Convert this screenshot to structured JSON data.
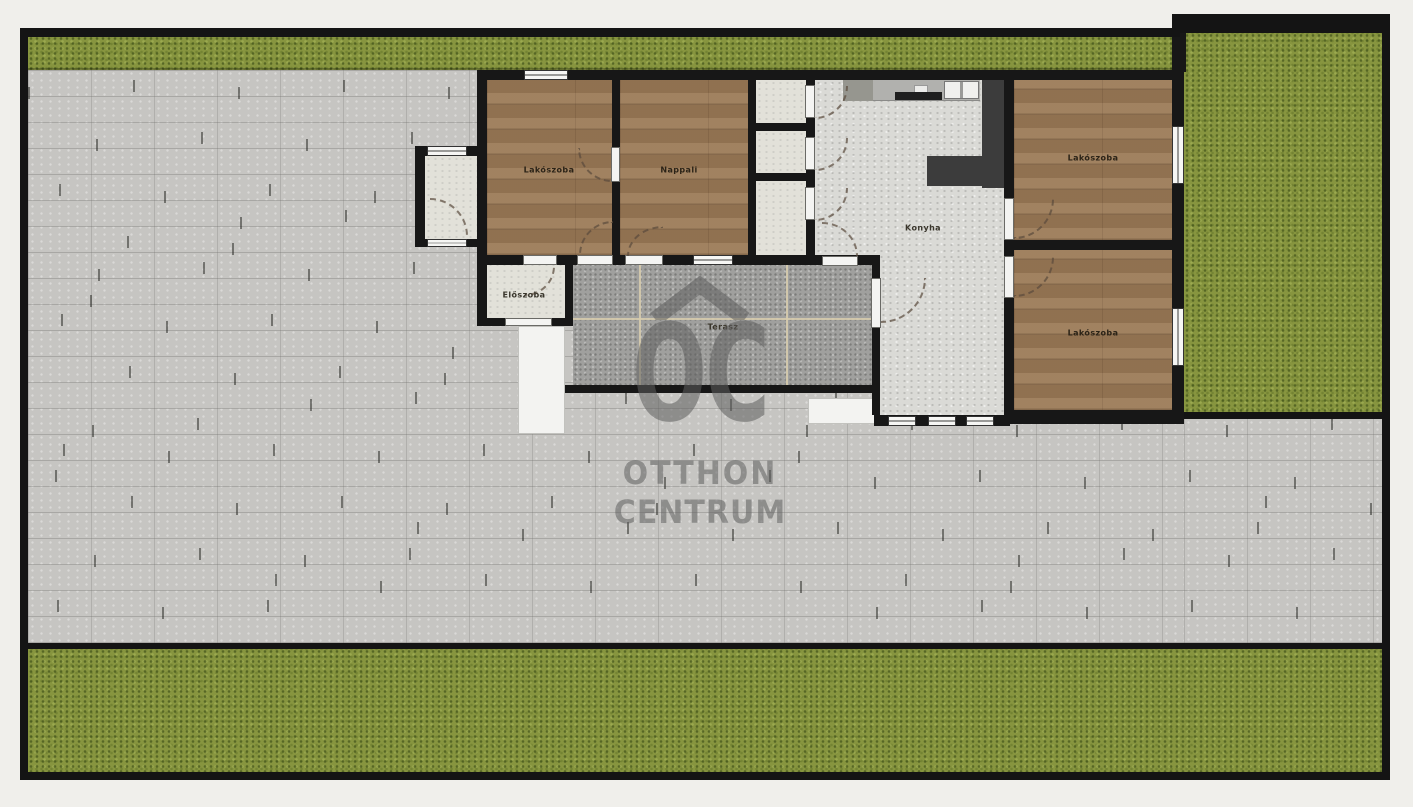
{
  "plan": {
    "rooms": {
      "bedroom1": {
        "label": "Lakószoba"
      },
      "living": {
        "label": "Nappali"
      },
      "kitchen": {
        "label": "Konyha"
      },
      "bedroom2": {
        "label": "Lakószoba"
      },
      "bedroom3": {
        "label": "Lakószoba"
      },
      "hallway": {
        "label": "Előszoba"
      },
      "terrace": {
        "label": "Terasz"
      }
    }
  },
  "watermark": {
    "logo": "OC",
    "name_line1": "OTTHON",
    "name_line2": "CENTRUM"
  },
  "colors": {
    "background": "#f0efeb",
    "plot_border": "#141414",
    "grass": "#87953f",
    "pavement": "#c6c5c2",
    "wood_floor": "#9a7a58",
    "terrace_tile": "#a0a09e",
    "light_floor": "#e2e1d9",
    "hall_floor": "#dadad6",
    "wall": "#171717",
    "kitchen_island_dark": "#3c3c3c",
    "watermark_gray": "#5f5f5f"
  }
}
